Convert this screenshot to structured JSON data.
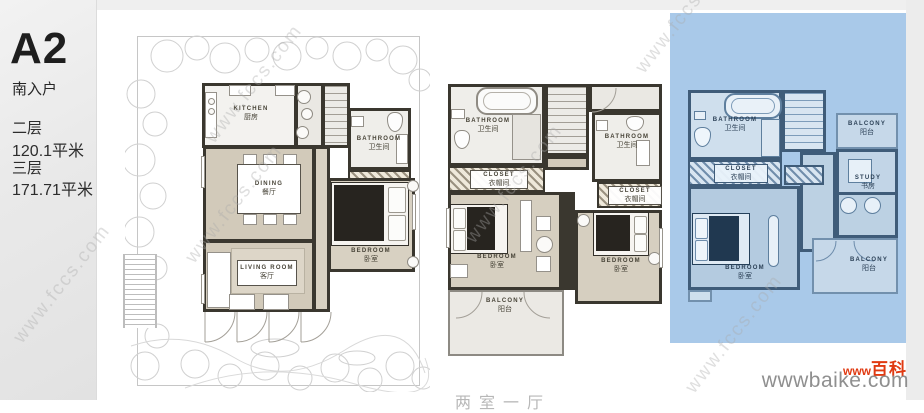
{
  "sidebar": {
    "unit_code": "A2",
    "entry_label": "南入户",
    "floors": [
      {
        "label": "二层",
        "area": "120.1平米"
      },
      {
        "label": "三层",
        "area": "171.71平米"
      }
    ]
  },
  "plans": {
    "left": {
      "kitchen": {
        "en": "KITCHEN",
        "cn": "厨房"
      },
      "bathroom": {
        "en": "BATHROOM",
        "cn": "卫生间"
      },
      "dining": {
        "en": "DINING",
        "cn": "餐厅"
      },
      "bedroom": {
        "en": "BEDROOM",
        "cn": "卧室"
      },
      "living": {
        "en": "LIVING ROOM",
        "cn": "客厅"
      }
    },
    "middle": {
      "bathroom_left": {
        "en": "BATHROOM",
        "cn": "卫生间"
      },
      "bathroom_right": {
        "en": "BATHROOM",
        "cn": "卫生间"
      },
      "closet_left": {
        "en": "CLOSET",
        "cn": "衣帽间"
      },
      "closet_right": {
        "en": "CLOSET",
        "cn": "衣帽间"
      },
      "bedroom_left": {
        "en": "BEDROOM",
        "cn": "卧室"
      },
      "bedroom_right": {
        "en": "BEDROOM",
        "cn": "卧室"
      },
      "balcony": {
        "en": "BALCONY",
        "cn": "阳台"
      }
    },
    "right": {
      "bathroom": {
        "en": "BATHROOM",
        "cn": "卫生间"
      },
      "balcony_top": {
        "en": "BALCONY",
        "cn": "阳台"
      },
      "closet": {
        "en": "CLOSET",
        "cn": "衣帽间"
      },
      "study": {
        "en": "STUDY",
        "cn": "书房"
      },
      "bedroom": {
        "en": "BEDROOM",
        "cn": "卧室"
      },
      "balcony_bottom": {
        "en": "BALCONY",
        "cn": "阳台"
      }
    }
  },
  "watermarks": {
    "fccs": "www.fccs.com",
    "baike_www": "www",
    "baike_name": "百科",
    "baike_url": "wwwbaike.com"
  },
  "bottom_caption": "两室一厅",
  "colors": {
    "floor3_panel_blue": "#a9c9e9",
    "baike_red": "#e03a12",
    "wall_dark": "#3a372f",
    "wall_blue": "#3f5c79"
  }
}
